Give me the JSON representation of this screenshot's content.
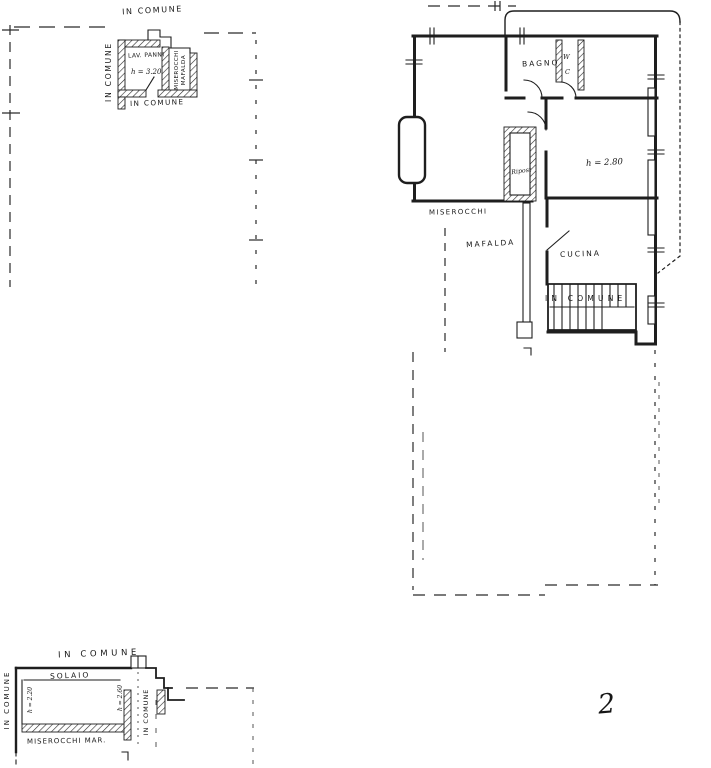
{
  "page": {
    "number": "2"
  },
  "colors": {
    "ink": "#1f1f1f",
    "paper": "#ffffff"
  },
  "plans": {
    "upper_left": {
      "labels": {
        "in_comune_top": "IN COMUNE",
        "in_comune_left": "IN COMUNE",
        "in_comune_bottom": "IN COMUNE",
        "room": "LAV. PANNI",
        "height": "h = 3.20",
        "owner_name_1": "MISEROCCHI",
        "owner_name_2": "MAFALDA"
      }
    },
    "main": {
      "labels": {
        "bagno": "BAGNO",
        "wc_line1": "W",
        "wc_line2": "C",
        "room_height": "h = 2.80",
        "ripostiglio": "Ripost",
        "owner_first": "MISEROCCHI",
        "owner_second": "MAFALDA",
        "cucina": "CUCINA",
        "stairs_in_comune": "IN COMUNE"
      }
    },
    "lower_left": {
      "labels": {
        "in_comune_top": "IN COMUNE",
        "in_comune_left": "IN COMUNE",
        "in_comune_right": "IN COMUNE",
        "solaio": "SOLAIO",
        "height_left": "h = 2.20",
        "height_right": "h = 2.60",
        "owner": "MISEROCCHI MAR."
      }
    }
  }
}
